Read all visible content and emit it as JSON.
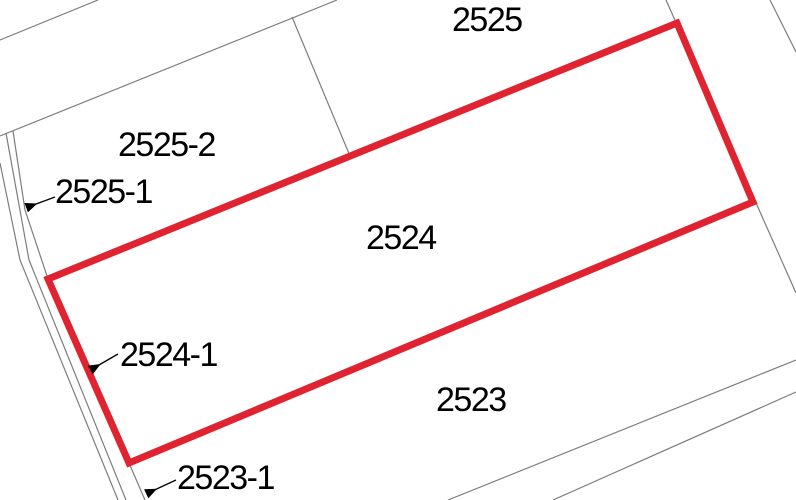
{
  "map": {
    "type": "cadastral-parcel-map",
    "background_color": "#ffffff",
    "boundary_color": "#7d7d7d",
    "highlight_color": "#e02330",
    "label_color": "#000000"
  },
  "selected_parcel": {
    "label": "2524"
  },
  "parcels": [
    {
      "label": "2525",
      "highlighted": false,
      "leader_arrow": false
    },
    {
      "label": "2525-2",
      "highlighted": false,
      "leader_arrow": false
    },
    {
      "label": "2525-1",
      "highlighted": false,
      "leader_arrow": true
    },
    {
      "label": "2524",
      "highlighted": true,
      "leader_arrow": false
    },
    {
      "label": "2524-1",
      "highlighted": false,
      "leader_arrow": true
    },
    {
      "label": "2523",
      "highlighted": false,
      "leader_arrow": false
    },
    {
      "label": "2523-1",
      "highlighted": false,
      "leader_arrow": true
    }
  ]
}
